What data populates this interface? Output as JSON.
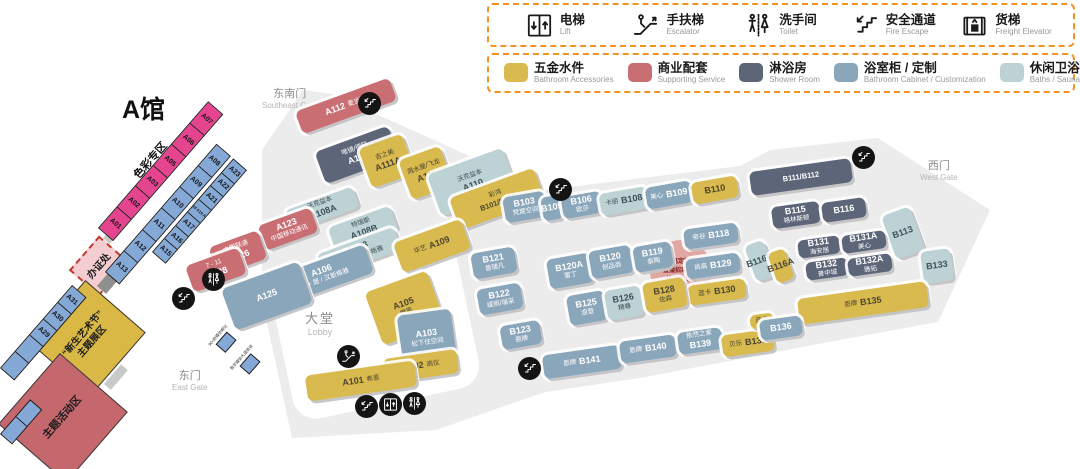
{
  "title": "A馆",
  "legend_facilities": [
    {
      "icon": "lift-icon",
      "cn": "电梯",
      "en": "Lift"
    },
    {
      "icon": "escalator-icon",
      "cn": "手扶梯",
      "en": "Escalator"
    },
    {
      "icon": "toilet-icon",
      "cn": "洗手间",
      "en": "Toilet"
    },
    {
      "icon": "fire-escape-icon",
      "cn": "安全通道",
      "en": "Fire Escape"
    },
    {
      "icon": "freight-elevator-icon",
      "cn": "货梯",
      "en": "Freight Elevator"
    }
  ],
  "legend_categories": [
    {
      "key": "acc",
      "color": "#d8ba4e",
      "cn": "五金水件",
      "en": "Bathroom Accessories"
    },
    {
      "key": "svc",
      "color": "#c96f73",
      "cn": "商业配套",
      "en": "Supporting Service"
    },
    {
      "key": "shower",
      "color": "#5d6679",
      "cn": "淋浴房",
      "en": "Shower Room"
    },
    {
      "key": "cabinet",
      "color": "#8aa6bb",
      "cn": "浴室柜 / 定制",
      "en": "Bathroom Cabinet / Customization"
    },
    {
      "key": "bath",
      "color": "#bdd2d5",
      "cn": "休闲卫浴 / 桑拿房 / 蒸汽房",
      "en": "Baths / Sauna Room / Steam Room"
    }
  ],
  "gates": [
    {
      "cn": "东南门",
      "en": "Southeast Gate",
      "x": 262,
      "y": 88
    },
    {
      "cn": "西门",
      "en": "West Gate",
      "x": 920,
      "y": 160
    },
    {
      "cn": "东门",
      "en": "East Gate",
      "x": 172,
      "y": 370
    }
  ],
  "lobby": {
    "cn": "大堂",
    "en": "Lobby"
  },
  "color_zone_label": "色彩专区",
  "zones": {
    "office": {
      "label": "办证处"
    },
    "art": {
      "line1": "“新生艺术节”",
      "line2": "主题展区"
    },
    "theme": {
      "label": "主题活动区"
    }
  },
  "notice": {
    "lines": [
      "卫浴高定新空间",
      "直播招商大会",
      "线下洽谈区"
    ]
  },
  "mini_booths": [
    {
      "label": "90+新媒体孵化",
      "x": 210,
      "y": 330
    },
    {
      "label": "数字媒体大道商谈",
      "x": 231,
      "y": 352
    }
  ],
  "strips": [
    {
      "name": "strip-color-zone",
      "style": "pink",
      "x": 98,
      "y": 228,
      "len": 168,
      "h": 20,
      "angle": -49,
      "cells": [
        "A01",
        "A02",
        "A03",
        "A05",
        "A06",
        "A07"
      ]
    },
    {
      "name": "strip-a08-a13",
      "style": "blue",
      "x": 105,
      "y": 272,
      "len": 170,
      "h": 19,
      "angle": -49,
      "cells": [
        "A13",
        "A12",
        "A11",
        "A10",
        "A09",
        "A08"
      ]
    },
    {
      "name": "strip-a15-a23",
      "style": "blue",
      "x": 152,
      "y": 252,
      "len": 124,
      "h": 18,
      "angle": -49,
      "cells": [
        "A15",
        "A16",
        "A17",
        "A18 A19 A20",
        "A21",
        "A22",
        "A23"
      ]
    },
    {
      "name": "strip-a29-a31",
      "style": "blue",
      "x": 0,
      "y": 368,
      "len": 110,
      "h": 19,
      "angle": -49,
      "cells": [
        "",
        "",
        "A29",
        "A30",
        "A31"
      ]
    },
    {
      "name": "strip-a24",
      "style": "blue",
      "x": 0,
      "y": 434,
      "len": 46,
      "h": 16,
      "angle": -49,
      "cells": [
        "",
        ""
      ]
    }
  ],
  "booths": [
    {
      "id": "A112",
      "brand": "麦当劳",
      "cat": "svc",
      "bp": "right",
      "x": 296,
      "y": 94,
      "w": 100,
      "h": 24,
      "r": -20
    },
    {
      "id": "A113",
      "brand": "唯镜/德陆",
      "cat": "shower",
      "bp": "above",
      "x": 318,
      "y": 138,
      "w": 78,
      "h": 34,
      "r": -20
    },
    {
      "id": "A111A",
      "brand": "吉之美",
      "cat": "acc",
      "bp": "above",
      "x": 364,
      "y": 140,
      "w": 46,
      "h": 42,
      "r": -20
    },
    {
      "id": "A111",
      "brand": "溅水屋/飞龙",
      "cat": "acc",
      "bp": "above",
      "x": 404,
      "y": 152,
      "w": 44,
      "h": 42,
      "r": -20
    },
    {
      "id": "A110",
      "brand": "沃克益本",
      "cat": "bath",
      "bp": "above",
      "x": 432,
      "y": 160,
      "w": 80,
      "h": 44,
      "r": -20
    },
    {
      "id": "B101/B102",
      "brand": "彩鸿",
      "cat": "acc",
      "bp": "above",
      "x": 452,
      "y": 182,
      "w": 90,
      "h": 34,
      "r": -20
    },
    {
      "id": "A108A",
      "brand": "沃克益本",
      "cat": "bath",
      "bp": "above",
      "x": 286,
      "y": 198,
      "w": 72,
      "h": 22,
      "r": -20
    },
    {
      "id": "A123",
      "brand": "中国移动通讯",
      "cat": "svc",
      "bp": "below",
      "x": 260,
      "y": 216,
      "w": 56,
      "h": 26,
      "r": -20
    },
    {
      "id": "A108B",
      "brand": "特瑞斯",
      "cat": "bath",
      "bp": "above",
      "x": 330,
      "y": 216,
      "w": 66,
      "h": 26,
      "r": -20
    },
    {
      "id": "A108",
      "brand": "浴+居 / 汉斯格雅",
      "cat": "bath",
      "bp": "below",
      "x": 318,
      "y": 240,
      "w": 82,
      "h": 24,
      "r": -20
    },
    {
      "id": "A126",
      "brand": "中国联通",
      "cat": "svc",
      "bp": "above",
      "x": 212,
      "y": 238,
      "w": 52,
      "h": 30,
      "r": -20
    },
    {
      "id": "A106",
      "brand": "浴 + 居 / 汉斯格雅",
      "cat": "cabinet",
      "bp": "below",
      "x": 274,
      "y": 260,
      "w": 98,
      "h": 30,
      "r": -20
    },
    {
      "id": "A128",
      "brand": "7 - 11",
      "cat": "svc",
      "bp": "above",
      "x": 188,
      "y": 256,
      "w": 56,
      "h": 28,
      "r": -20
    },
    {
      "id": "A125",
      "brand": "",
      "cat": "cabinet",
      "bp": "none",
      "x": 226,
      "y": 274,
      "w": 82,
      "h": 44,
      "r": -20
    },
    {
      "id": "A109",
      "brand": "华艺",
      "cat": "acc",
      "bp": "left",
      "x": 396,
      "y": 230,
      "w": 72,
      "h": 32,
      "r": -20
    },
    {
      "id": "A105",
      "brand": "摩恩",
      "cat": "acc",
      "bp": "below",
      "x": 372,
      "y": 280,
      "w": 66,
      "h": 56,
      "r": -20
    },
    {
      "id": "A103",
      "brand": "松下住空间",
      "cat": "cabinet",
      "bp": "below",
      "x": 400,
      "y": 312,
      "w": 54,
      "h": 52,
      "r": -8
    },
    {
      "id": "A102",
      "brand": "高仪",
      "cat": "acc",
      "bp": "right",
      "x": 384,
      "y": 354,
      "w": 74,
      "h": 24,
      "r": -8
    },
    {
      "id": "A101",
      "brand": "希恩",
      "cat": "acc",
      "bp": "right",
      "x": 306,
      "y": 368,
      "w": 110,
      "h": 26,
      "r": -8
    },
    {
      "id": "B103",
      "brand": "梵度空间",
      "cat": "cabinet",
      "bp": "below",
      "x": 504,
      "y": 194,
      "w": 42,
      "h": 26,
      "r": -10
    },
    {
      "id": "B105",
      "brand": "",
      "cat": "cabinet",
      "bp": "none",
      "x": 542,
      "y": 196,
      "w": 20,
      "h": 24,
      "r": -10
    },
    {
      "id": "B106",
      "brand": "欧莎",
      "cat": "cabinet",
      "bp": "below",
      "x": 562,
      "y": 194,
      "w": 40,
      "h": 22,
      "r": -10
    },
    {
      "id": "B108",
      "brand": "卡丽",
      "cat": "bath",
      "bp": "left",
      "x": 600,
      "y": 190,
      "w": 48,
      "h": 22,
      "r": -10
    },
    {
      "id": "B109",
      "brand": "美心",
      "cat": "cabinet",
      "bp": "left",
      "x": 646,
      "y": 184,
      "w": 46,
      "h": 22,
      "r": -10
    },
    {
      "id": "B110",
      "brand": "",
      "cat": "acc",
      "bp": "none",
      "x": 692,
      "y": 179,
      "w": 46,
      "h": 22,
      "r": -10
    },
    {
      "id": "B111/B112",
      "brand": "",
      "cat": "shower",
      "bp": "none",
      "x": 750,
      "y": 165,
      "w": 102,
      "h": 24,
      "r": -8
    },
    {
      "id": "B115",
      "brand": "格林斯顿",
      "cat": "shower",
      "bp": "below",
      "x": 772,
      "y": 204,
      "w": 48,
      "h": 22,
      "r": -8
    },
    {
      "id": "B116",
      "brand": "",
      "cat": "shower",
      "bp": "none",
      "x": 822,
      "y": 200,
      "w": 44,
      "h": 20,
      "r": -8
    },
    {
      "id": "B113",
      "brand": "",
      "cat": "bath",
      "bp": "none",
      "x": 888,
      "y": 210,
      "w": 30,
      "h": 46,
      "r": -20
    },
    {
      "id": "B118",
      "brand": "帝谷",
      "cat": "cabinet",
      "bp": "left",
      "x": 684,
      "y": 226,
      "w": 54,
      "h": 20,
      "r": -8
    },
    {
      "id": "B116B",
      "brand": "",
      "cat": "bath",
      "bp": "none",
      "x": 750,
      "y": 242,
      "w": 20,
      "h": 38,
      "r": -20
    },
    {
      "id": "B116A",
      "brand": "",
      "cat": "acc",
      "bp": "none",
      "x": 772,
      "y": 250,
      "w": 18,
      "h": 32,
      "r": -20
    },
    {
      "id": "B129",
      "brand": "尚高",
      "cat": "cabinet",
      "bp": "left",
      "x": 686,
      "y": 256,
      "w": 54,
      "h": 20,
      "r": -8
    },
    {
      "id": "B130",
      "brand": "蓝卡",
      "cat": "acc",
      "bp": "left",
      "x": 688,
      "y": 282,
      "w": 58,
      "h": 20,
      "r": -8
    },
    {
      "id": "B131",
      "brand": "海安居",
      "cat": "shower",
      "bp": "below",
      "x": 798,
      "y": 238,
      "w": 42,
      "h": 18,
      "r": -8
    },
    {
      "id": "B131A",
      "brand": "美心",
      "cat": "shower",
      "bp": "below",
      "x": 842,
      "y": 233,
      "w": 44,
      "h": 18,
      "r": -8
    },
    {
      "id": "B132",
      "brand": "普中城",
      "cat": "shower",
      "bp": "below",
      "x": 806,
      "y": 260,
      "w": 42,
      "h": 18,
      "r": -8
    },
    {
      "id": "B132A",
      "brand": "雅拓",
      "cat": "shower",
      "bp": "below",
      "x": 848,
      "y": 256,
      "w": 44,
      "h": 18,
      "r": -8
    },
    {
      "id": "B133",
      "brand": "",
      "cat": "bath",
      "bp": "none",
      "x": 922,
      "y": 250,
      "w": 30,
      "h": 32,
      "r": -8
    },
    {
      "id": "B135",
      "brand": "恩牌",
      "cat": "acc",
      "bp": "left",
      "x": 798,
      "y": 290,
      "w": 130,
      "h": 26,
      "r": -8
    },
    {
      "id": "B121",
      "brand": "普瑞凡",
      "cat": "cabinet",
      "bp": "below",
      "x": 472,
      "y": 250,
      "w": 44,
      "h": 26,
      "r": -10
    },
    {
      "id": "B122",
      "brand": "缇雨/瑞采",
      "cat": "cabinet",
      "bp": "below",
      "x": 478,
      "y": 286,
      "w": 44,
      "h": 26,
      "r": -10
    },
    {
      "id": "B123",
      "brand": "恩牌",
      "cat": "cabinet",
      "bp": "below",
      "x": 501,
      "y": 323,
      "w": 40,
      "h": 24,
      "r": -10
    },
    {
      "id": "B120A",
      "brand": "雷丁",
      "cat": "cabinet",
      "bp": "below",
      "x": 548,
      "y": 256,
      "w": 44,
      "h": 30,
      "r": -10
    },
    {
      "id": "B120",
      "brand": "创品商",
      "cat": "cabinet",
      "bp": "below",
      "x": 590,
      "y": 248,
      "w": 42,
      "h": 28,
      "r": -10
    },
    {
      "id": "B119",
      "brand": "泰陶",
      "cat": "cabinet",
      "bp": "below",
      "x": 634,
      "y": 244,
      "w": 38,
      "h": 26,
      "r": -10
    },
    {
      "id": "B125",
      "brand": "浪登",
      "cat": "cabinet",
      "bp": "below",
      "x": 568,
      "y": 293,
      "w": 38,
      "h": 30,
      "r": -10
    },
    {
      "id": "B126",
      "brand": "精尊",
      "cat": "bath",
      "bp": "below",
      "x": 606,
      "y": 288,
      "w": 36,
      "h": 30,
      "r": -10
    },
    {
      "id": "B128",
      "brand": "佐森",
      "cat": "acc",
      "bp": "below",
      "x": 644,
      "y": 280,
      "w": 42,
      "h": 30,
      "r": -10
    },
    {
      "id": "B141",
      "brand": "恩牌",
      "cat": "cabinet",
      "bp": "left",
      "x": 543,
      "y": 350,
      "w": 78,
      "h": 24,
      "r": -8
    },
    {
      "id": "B140",
      "brand": "恩牌",
      "cat": "cabinet",
      "bp": "left",
      "x": 620,
      "y": 338,
      "w": 56,
      "h": 22,
      "r": -8
    },
    {
      "id": "B139",
      "brand": "依然之家",
      "cat": "cabinet",
      "bp": "above",
      "x": 678,
      "y": 330,
      "w": 44,
      "h": 22,
      "r": -8
    },
    {
      "id": "B138",
      "brand": "贝乐",
      "cat": "acc",
      "bp": "left",
      "x": 722,
      "y": 332,
      "w": 52,
      "h": 22,
      "r": -8
    },
    {
      "id": "",
      "brand": "蓝卡",
      "cat": "acc",
      "bp": "only",
      "x": 750,
      "y": 314,
      "w": 24,
      "h": 14,
      "r": -8
    },
    {
      "id": "B136",
      "brand": "",
      "cat": "cabinet",
      "bp": "none",
      "x": 760,
      "y": 318,
      "w": 42,
      "h": 20,
      "r": -8
    }
  ],
  "map_icons": [
    {
      "type": "fire-escape-icon",
      "x": 358,
      "y": 92
    },
    {
      "type": "fire-escape-icon",
      "x": 549,
      "y": 178
    },
    {
      "type": "fire-escape-icon",
      "x": 852,
      "y": 146
    },
    {
      "type": "toilet-icon",
      "x": 202,
      "y": 268
    },
    {
      "type": "fire-escape-icon",
      "x": 172,
      "y": 287
    },
    {
      "type": "escalator-icon",
      "x": 337,
      "y": 345
    },
    {
      "type": "fire-escape-icon",
      "x": 355,
      "y": 395
    },
    {
      "type": "lift-icon",
      "x": 379,
      "y": 393
    },
    {
      "type": "toilet-icon",
      "x": 403,
      "y": 392
    },
    {
      "type": "fire-escape-icon",
      "x": 518,
      "y": 357
    }
  ]
}
